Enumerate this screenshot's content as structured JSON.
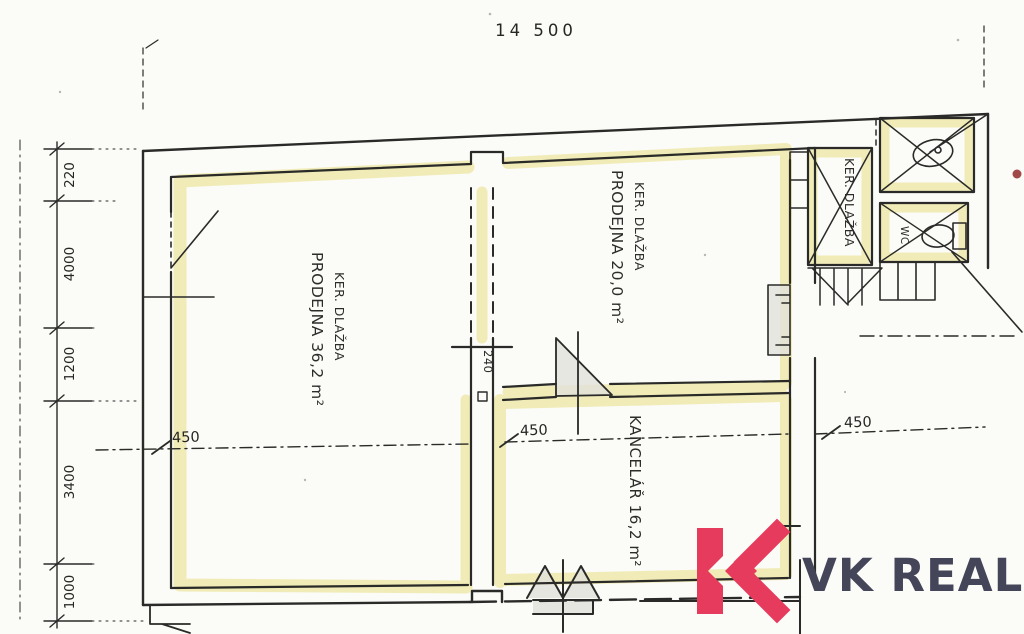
{
  "document": {
    "kind": "scanned floor plan with highlighter marks and realty watermark"
  },
  "dims": {
    "top": "14 500",
    "left": [
      "220",
      "4000",
      "1200",
      "3400",
      "1000"
    ],
    "sill": [
      "450",
      "450",
      "450"
    ],
    "door_width": "240"
  },
  "rooms": {
    "prodejna1": {
      "line1": "PRODEJNA 36,2 m²",
      "line2": "KER. DLAŽBA"
    },
    "prodejna2": {
      "line1": "PRODEJNA 20,0 m²",
      "line2": "KER. DLAŽBA"
    },
    "kancelar": {
      "line1": "KANCELÁŘ 16,2 m²"
    },
    "chodba": {
      "line1": "KER. DLAŽBA"
    },
    "wc": {
      "line1": "WC"
    }
  },
  "logo": {
    "text": "VK REAL"
  },
  "colors": {
    "paper": "#fbfbf8",
    "ink": "#2a2a28",
    "highlight": "#efe9ac",
    "logo_pink": "#e73b5e",
    "logo_navy": "#45455a",
    "red_dot": "#a14848"
  }
}
